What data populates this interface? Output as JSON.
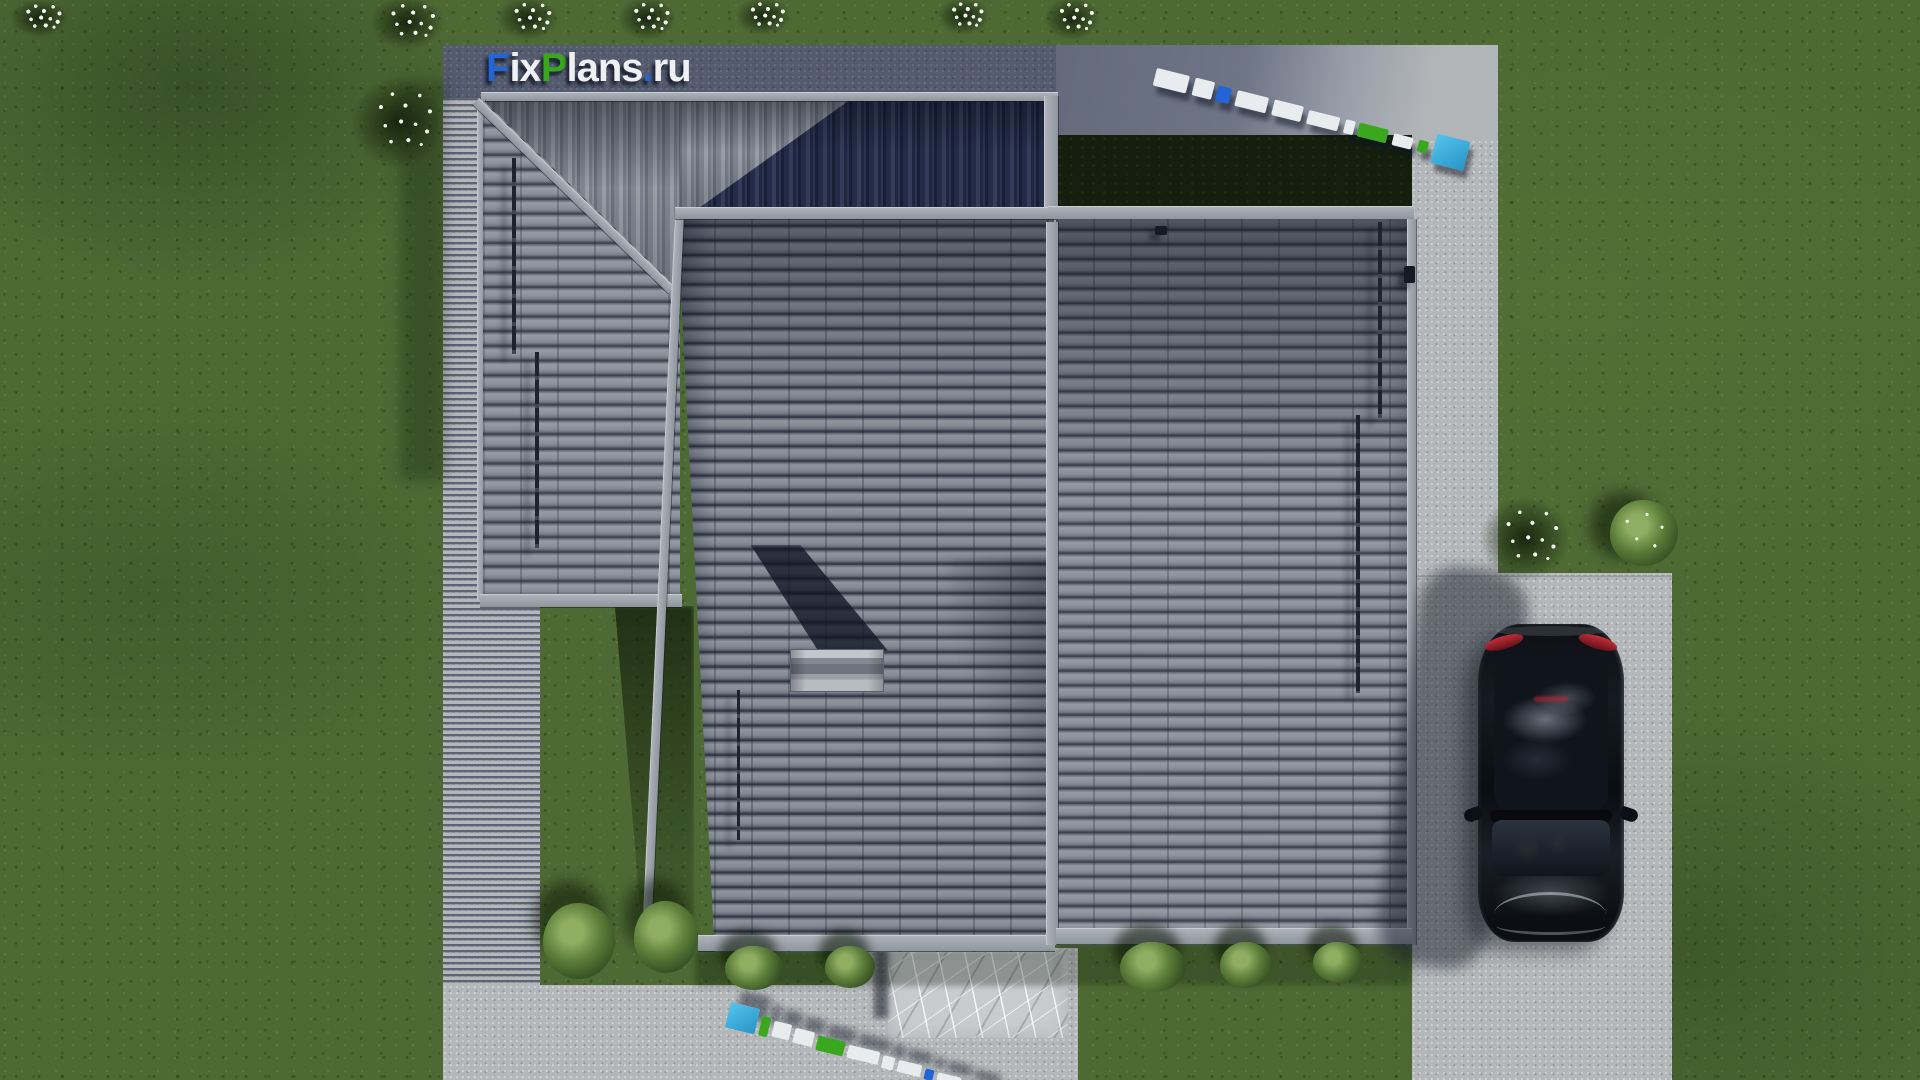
{
  "brand": {
    "logo_text_full": "FixPlans.ru",
    "logo_segments": [
      {
        "text": "F",
        "color": "#2465d6"
      },
      {
        "text": "ix",
        "color": "#eef0f2"
      },
      {
        "text": "P",
        "color": "#3aa81f"
      },
      {
        "text": "lans",
        "color": "#eef0f2"
      },
      {
        "text": ".",
        "color": "#2465d6"
      },
      {
        "text": "ru",
        "color": "#eef0f2"
      }
    ]
  },
  "watermarks": {
    "top_right": {
      "text": "FixPlans.ru",
      "style": "3D extruded letters lying on paving"
    },
    "bottom_center": {
      "text": "FixPlans.ru",
      "style": "3D extruded letters lying on paving"
    }
  },
  "palette": {
    "grass": "#4e6a34",
    "grass_deep_shadow": "#141f0e",
    "paving_light": "#b4b7b9",
    "paving_shadow": "#59606f",
    "roof_tile_light": "#8f959f",
    "roof_tile_gap": "#2f3542",
    "roof_north_shadow": "#1e2640",
    "ridge_bar": "#9aa0a8",
    "marble_path": "#c9cccf",
    "car_body": "#0c1016",
    "car_taillight": "#c22733",
    "accent_blue": "#2465d6",
    "accent_green": "#3aa81f",
    "accent_cyan": "#35aee0",
    "flower_white": "#f4f4ef"
  }
}
